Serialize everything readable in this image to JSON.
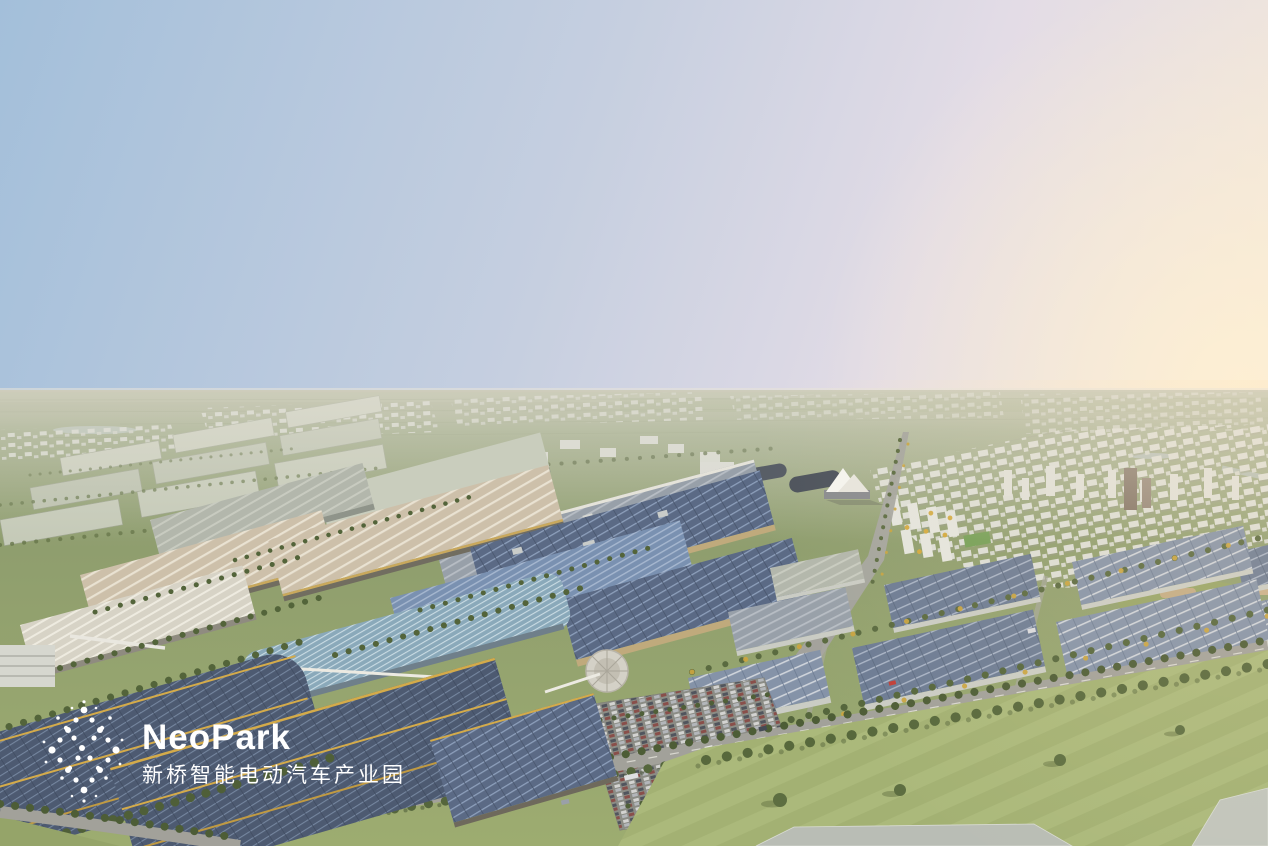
{
  "page": {
    "title": "NeoPark 新桥智能电动汽车产业园 — aerial rendering"
  },
  "logo": {
    "brand": "NeoPark",
    "tagline": "新桥智能电动汽车产业园"
  },
  "palette": {
    "sky_blue": "#a5c0da",
    "sky_pink": "#e6dce6",
    "sky_warm": "#f5e9d7",
    "field_green": "#93a171",
    "lawn_green": "#a3b173",
    "solar_roof_dark": "#4d5a71",
    "solar_roof": "#5b6a85",
    "solar_roof_light": "#8593a8",
    "solar_stripe": "#8d9fbb",
    "tan_roof": "#cdc0aa",
    "gold_trim": "#c9a85c",
    "tree_green": "#55663c",
    "autumn_tree": "#c9a440",
    "road_gray": "#a2a19a",
    "town_white": "#dcded6",
    "logo_white": "#ffffff"
  }
}
